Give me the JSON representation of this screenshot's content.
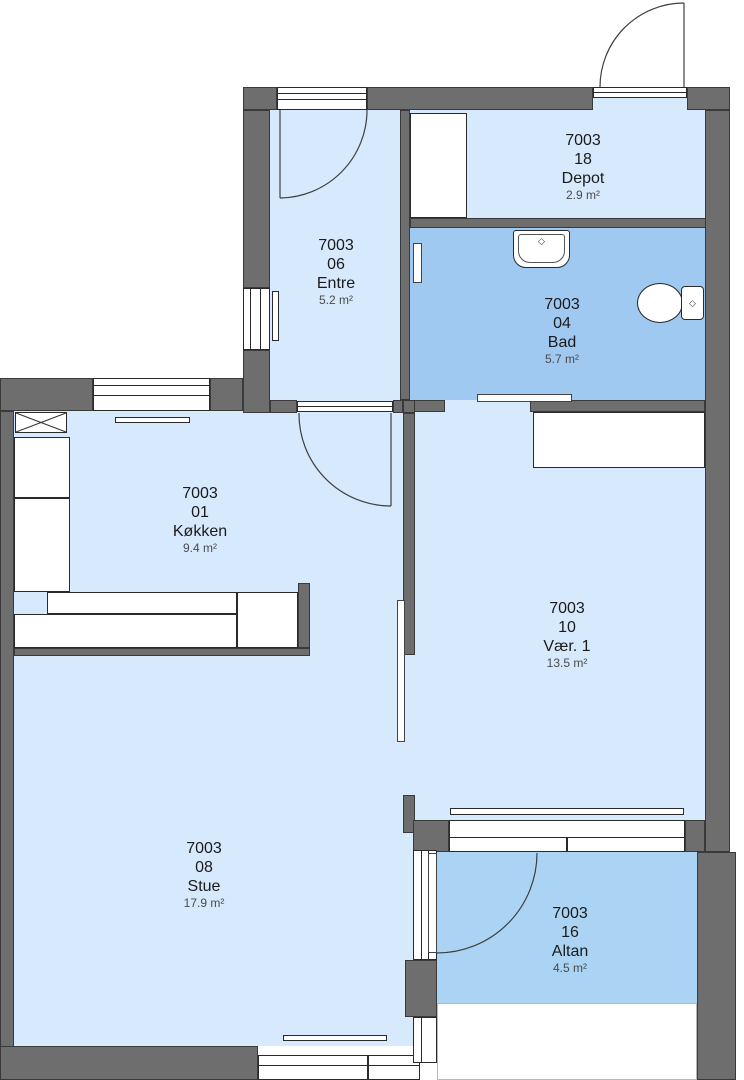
{
  "plan": {
    "type": "apartment-floor-plan",
    "rooms": [
      {
        "building": "7003",
        "number": "18",
        "name": "Depot",
        "area": "2.9 m²"
      },
      {
        "building": "7003",
        "number": "06",
        "name": "Entre",
        "area": "5.2 m²"
      },
      {
        "building": "7003",
        "number": "04",
        "name": "Bad",
        "area": "5.7 m²"
      },
      {
        "building": "7003",
        "number": "01",
        "name": "Køkken",
        "area": "9.4 m²"
      },
      {
        "building": "7003",
        "number": "10",
        "name": "Vær. 1",
        "area": "13.5 m²"
      },
      {
        "building": "7003",
        "number": "08",
        "name": "Stue",
        "area": "17.9 m²"
      },
      {
        "building": "7003",
        "number": "16",
        "name": "Altan",
        "area": "4.5 m²"
      }
    ],
    "colors": {
      "wall": "#6e6e6e",
      "room_light": "#d7e9fc",
      "room_bathroom": "#9fc9f1",
      "room_balcony": "#abd4f4",
      "fixture": "#ffffff",
      "outline": "#2a2a2a",
      "text": "#1b1b1b",
      "area_text": "#4a4a4a"
    },
    "fixtures": [
      "sink",
      "toilet",
      "kitchen-counter",
      "wardrobe",
      "closet",
      "radiator",
      "ventilation-shaft"
    ]
  }
}
